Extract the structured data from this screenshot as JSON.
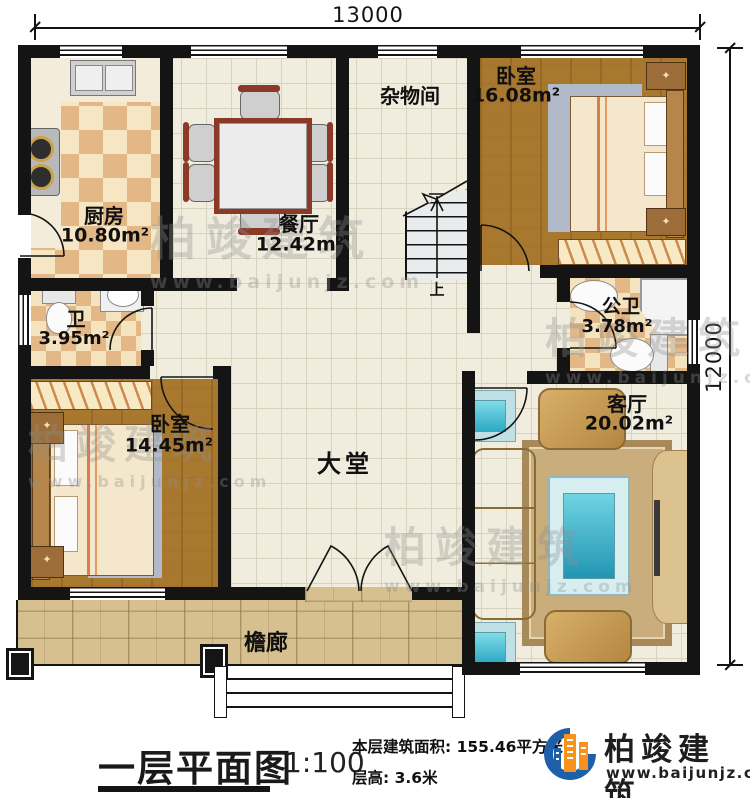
{
  "dimensions": {
    "width": "13000",
    "height": "12000"
  },
  "rooms": {
    "kitchen": {
      "name": "厨房",
      "area": "10.80m²"
    },
    "dining": {
      "name": "餐厅",
      "area": "12.42m²"
    },
    "storage": {
      "name": "杂物间"
    },
    "bedroom_top": {
      "name": "卧室",
      "area": "16.08m²"
    },
    "bath": {
      "name": "卫",
      "area": "3.95m²"
    },
    "public_bath": {
      "name": "公卫",
      "area": "3.78m²"
    },
    "bedroom_left": {
      "name": "卧室",
      "area": "14.45m²"
    },
    "hall": {
      "name": "大堂"
    },
    "living": {
      "name": "客厅",
      "area": "20.02m²"
    },
    "veranda": {
      "name": "檐廊"
    }
  },
  "stairs": {
    "up_label": "上"
  },
  "title_block": {
    "title": "一层平面图",
    "scale": "1:100",
    "area_label": "本层建筑面积:",
    "area_value": "155.46平方米",
    "floor_height_label": "层高:",
    "floor_height_value": "3.6米"
  },
  "branding": {
    "company": "柏竣建筑",
    "website": "www.baijunjz.com",
    "brand_blue": "#1d5fa8",
    "brand_orange": "#f6921e"
  }
}
